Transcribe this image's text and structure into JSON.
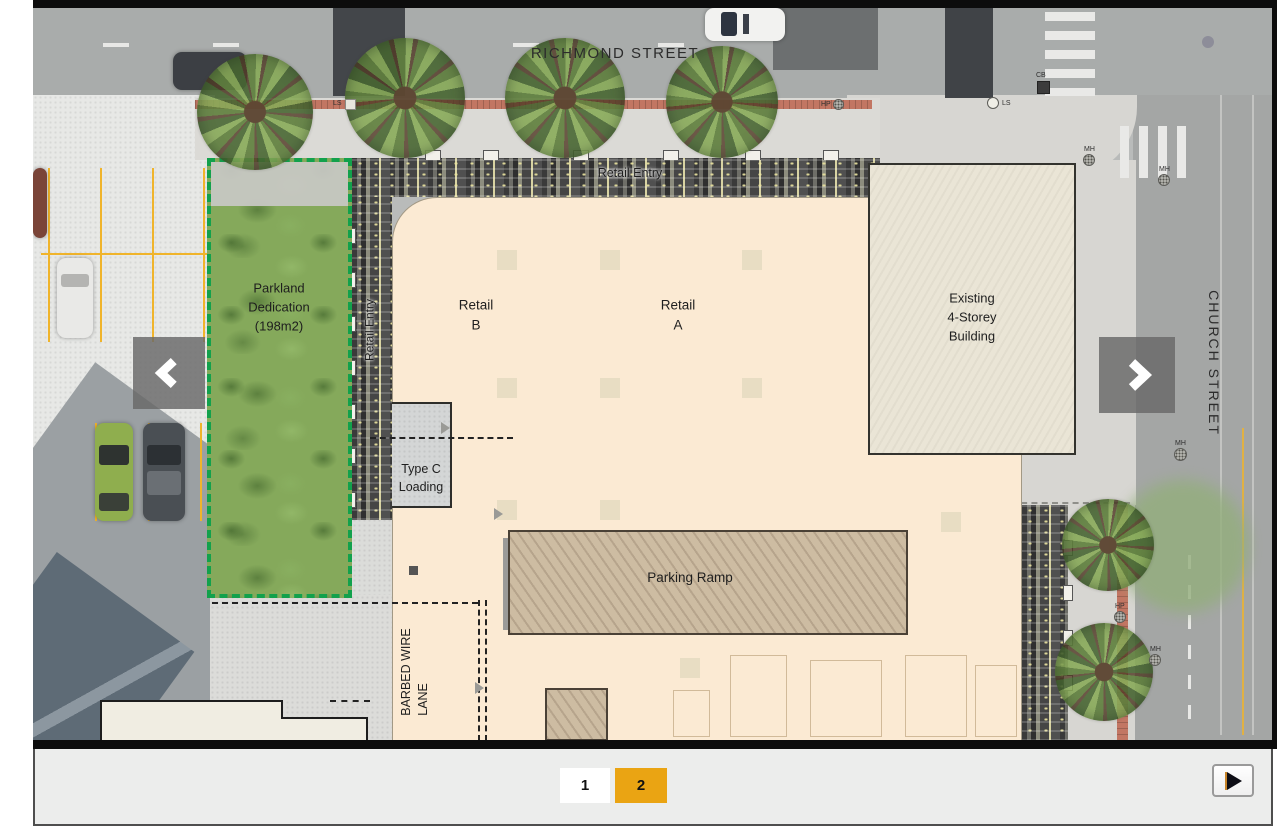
{
  "carousel": {
    "prev_button": {
      "icon": "chevron-left"
    },
    "next_button": {
      "icon": "chevron-right"
    },
    "play_button": {
      "icon": "play"
    },
    "pagination": {
      "pages": [
        {
          "label": "1",
          "active": false
        },
        {
          "label": "2",
          "active": true
        }
      ]
    }
  },
  "site_plan": {
    "streets": {
      "richmond": "RICHMOND STREET",
      "church": "CHURCH STREET",
      "barbed_wire_lane": "BARBED WIRE\nLANE"
    },
    "labels": {
      "retail_entry_top": "Retail Entry",
      "retail_entry_side": "Retail Entry",
      "parkland": "Parkland\nDedication\n(198m2)",
      "retail_b": "Retail\nB",
      "retail_a": "Retail\nA",
      "existing_building": "Existing\n4-Storey\nBuilding",
      "type_c_loading": "Type C\nLoading",
      "parking_ramp": "Parking Ramp"
    },
    "markers": {
      "ls_top": "LS",
      "hp_top": "HP",
      "ls_corner": "LS",
      "cb_corner": "CB",
      "mh_corner_1": "MH",
      "mh_corner_2": "MH",
      "hp_right": "HP",
      "mh_right_1": "MH",
      "mh_right_2": "MH"
    },
    "colors": {
      "accent_orange": "#EAA413",
      "parkland_dash_green": "#12A14C",
      "building_fill": "#FBEAD3",
      "existing_building_fill": "#EAE5D6",
      "parking_ramp_fill": "#CDBCA2",
      "paver_dark": "#4A4A4A",
      "control_bar_bg": "#ECEDEC"
    }
  }
}
